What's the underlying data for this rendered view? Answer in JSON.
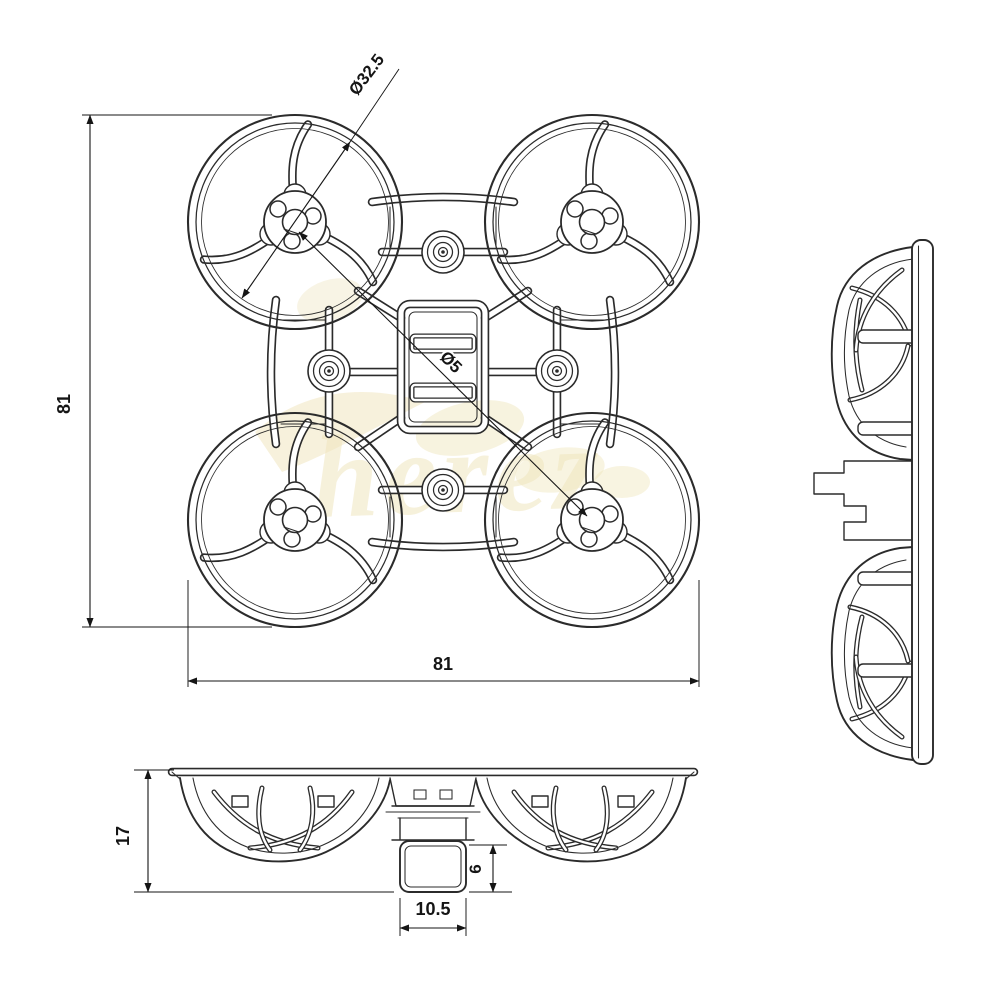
{
  "drawing": {
    "background": "#ffffff",
    "line_color": "#2b2b2b",
    "dim_text_color": "#151515",
    "views": {
      "top": {
        "duct_diameter_label": "Ø32.5",
        "center_hole_label": "Ø5",
        "width_label": "81",
        "height_label": "81"
      },
      "front": {
        "height_label": "17",
        "mount_height_label": "6",
        "mount_width_label": "10.5"
      }
    },
    "watermark": {
      "text": "herez",
      "color": "#ecdfae"
    }
  }
}
